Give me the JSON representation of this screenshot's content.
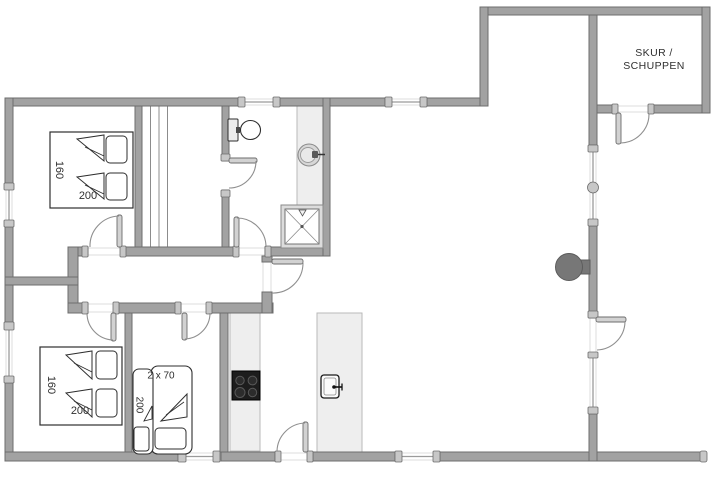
{
  "plan": {
    "shed": {
      "line1": "SKUR /",
      "line2": "SCHUPPEN"
    },
    "bedroom_top_left": {
      "width": "160",
      "length": "200"
    },
    "bedroom_bottom_left": {
      "width": "160",
      "length": "200"
    },
    "bunk_room": {
      "beds": "2 x 70",
      "length": "200"
    }
  },
  "colors": {
    "background": "#ffffff",
    "wall_fill": "#a2a2a2",
    "wall_edge": "#6d6d6d",
    "cap_fill": "#c7c7c7",
    "window_line": "#9b9b9b",
    "faint_line": "#dedede",
    "door_leaf_fill": "#d2d2d2",
    "door_arc": "#8f8f8f",
    "counter_fill": "#eeeeee",
    "counter_edge": "#b9b9b9",
    "fixture_outline": "#2e2e2e",
    "cooktop_fill": "#1d1d1d",
    "wood_stove_fill": "#777777",
    "label_color": "#2f2f2f"
  }
}
